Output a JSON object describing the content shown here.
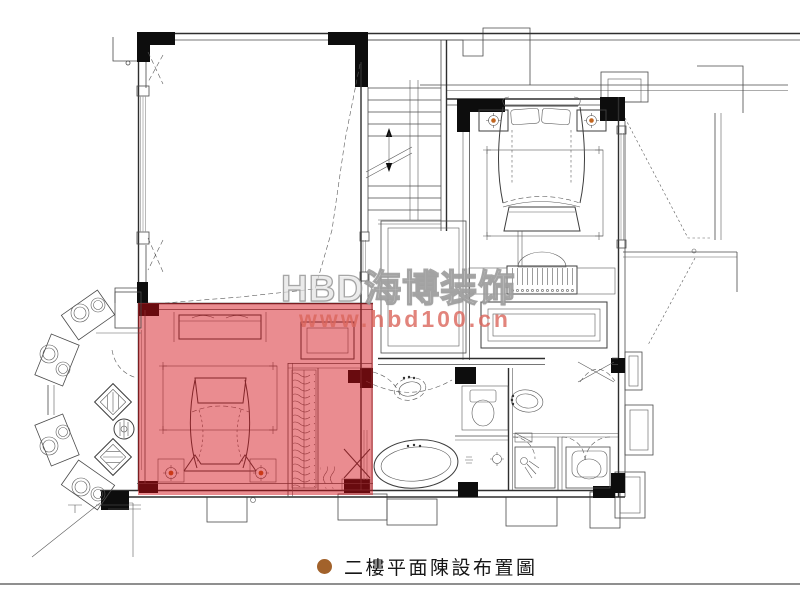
{
  "watermark": {
    "brand": "HBD海博装饰",
    "url": "www.hbd100.cn"
  },
  "caption": {
    "text": "二樓平面陳設布置圖"
  },
  "colors": {
    "highlight_red": "#d20a14",
    "bullet_brown": "#a2622b",
    "watermark_pink": "#db665c",
    "rule_gray": "#8f8f8f",
    "lamp_orange": "#c2651e"
  }
}
